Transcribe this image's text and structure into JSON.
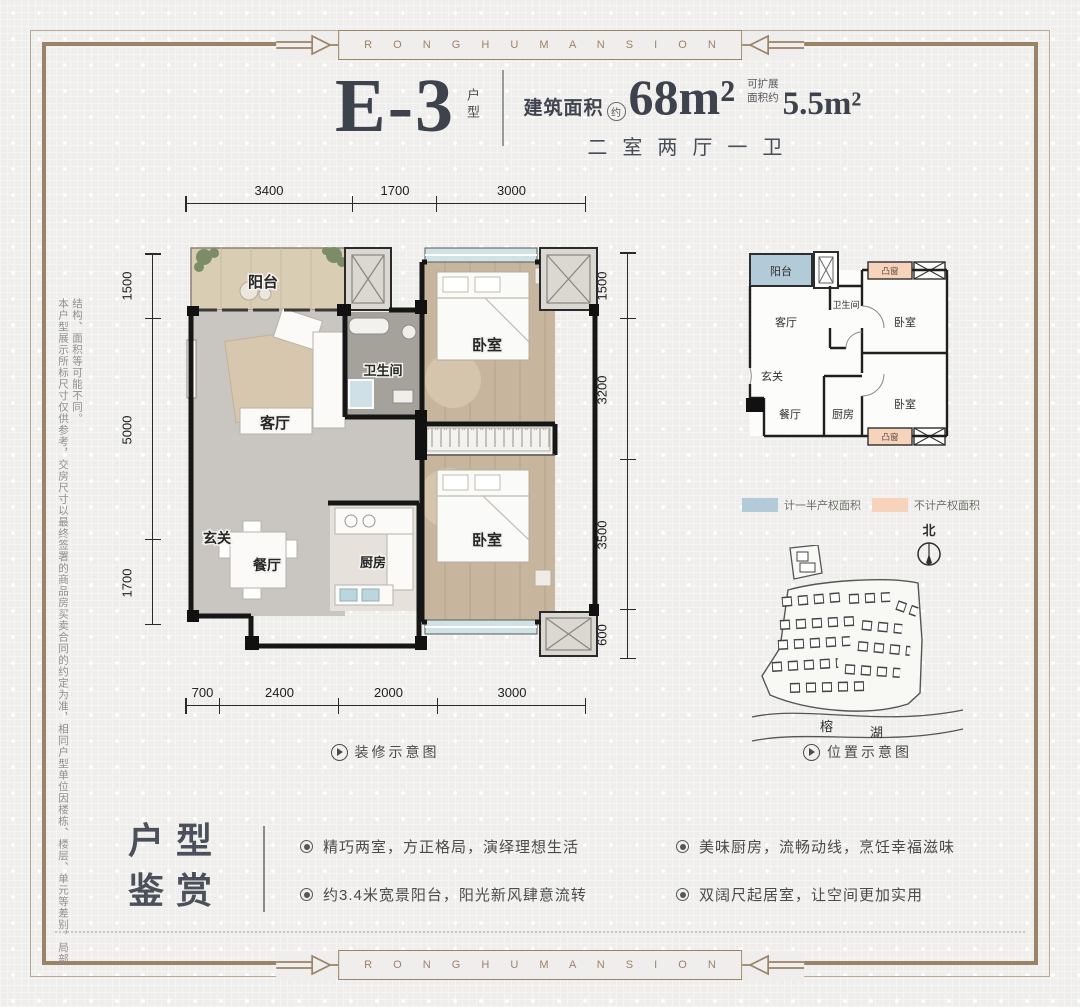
{
  "brand": {
    "name": "R O N G H U M A N S I O N",
    "frame_color": "#9b8366"
  },
  "header": {
    "unit_code": "E-3",
    "unit_suffix": "户型",
    "area_label": "建筑面积",
    "approx_mark": "约",
    "area_value": "68m²",
    "expand_label_line1": "可扩展",
    "expand_label_line2": "面积约",
    "expand_value": "5.5m²",
    "layout_desc": "二室两厅一卫"
  },
  "disclaimer": "本户型展示所标尺寸仅供参考，交房尺寸以最终签署的商品房买卖合同的约定为准，相同户型单位因楼栋、楼层、单元等差别，局部结构、面积等可能不同。",
  "main_plan": {
    "dims": {
      "top": [
        "3400",
        "1700",
        "3000"
      ],
      "left": [
        "1500",
        "5000",
        "1700"
      ],
      "right": [
        "1500",
        "3200",
        "3500",
        "600"
      ],
      "bottom": [
        "700",
        "2400",
        "2000",
        "3000"
      ]
    },
    "rooms": {
      "balcony": "阳台",
      "living": "客厅",
      "bath": "卫生间",
      "bedroom1": "卧室",
      "foyer": "玄关",
      "dining": "餐厅",
      "kitchen": "厨房",
      "bedroom2": "卧室"
    },
    "caption": "装修示意图"
  },
  "mini_plan": {
    "rooms": {
      "balcony": "阳台",
      "living": "客厅",
      "bath": "卫生间",
      "bedroom1": "卧室",
      "foyer": "玄关",
      "dining": "餐厅",
      "kitchen": "厨房",
      "bedroom2": "卧室",
      "bay_window": "凸窗"
    }
  },
  "legend": {
    "items": [
      {
        "label": "计一半产权面积",
        "color": "#b2cbd8"
      },
      {
        "label": "不计产权面积",
        "color": "#f6d3ba"
      }
    ]
  },
  "compass": {
    "north": "北"
  },
  "site_map": {
    "lake_char1": "榕",
    "lake_char2": "湖",
    "caption": "位置示意图"
  },
  "features": {
    "title_line1": "户型",
    "title_line2": "鉴赏",
    "bullets": [
      "精巧两室，方正格局，演绎理想生活",
      "约3.4米宽景阳台，阳光新风肆意流转",
      "美味厨房，流畅动线，烹饪幸福滋味",
      "双阔尺起居室，让空间更加实用"
    ]
  }
}
